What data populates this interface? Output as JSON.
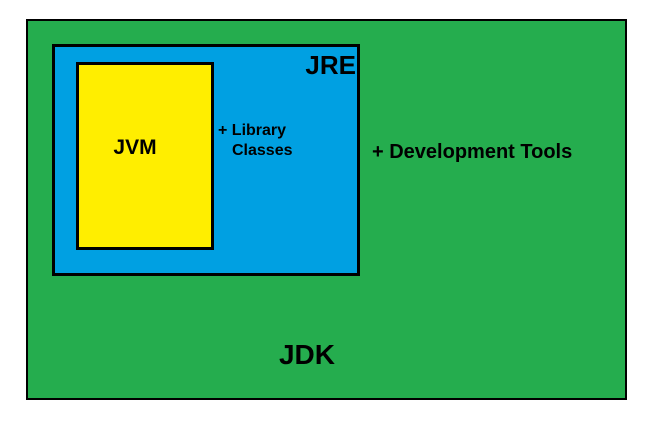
{
  "colors": {
    "background": "#ffffff",
    "border": "#000000",
    "text": "#000000",
    "jdk_green": "#25ad4e",
    "jre_blue": "#00a0e2",
    "jvm_yellow": "#ffee00"
  },
  "diagram": {
    "jdk_label": "JDK",
    "jre_label": "JRE",
    "jvm_label": "JVM",
    "library_classes_line1": "+ Library",
    "library_classes_line2": "Classes",
    "development_tools_label": "+ Development Tools"
  }
}
